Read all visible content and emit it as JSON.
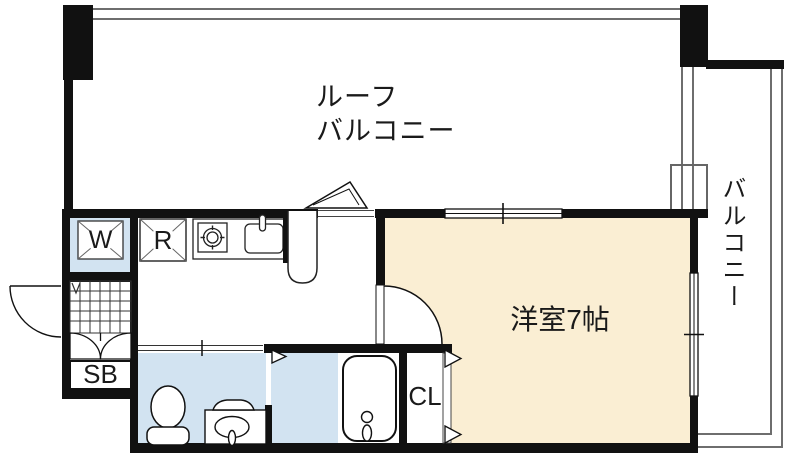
{
  "plan_title": "1K apartment floor plan",
  "labels": {
    "roof_balcony_line1": "ルーフ",
    "roof_balcony_line2": "バルコニー",
    "balcony": "バルコニー",
    "western_room": "洋室7帖",
    "washer": "W",
    "refrigerator": "R",
    "shoe_box": "SB",
    "closet": "CL"
  },
  "colors": {
    "floor_cream": "#FAEED3",
    "floor_blue": "#D2E3F1",
    "wall": "#111111",
    "line_gray": "#6e6e6e",
    "ink": "#1a1a1a"
  }
}
